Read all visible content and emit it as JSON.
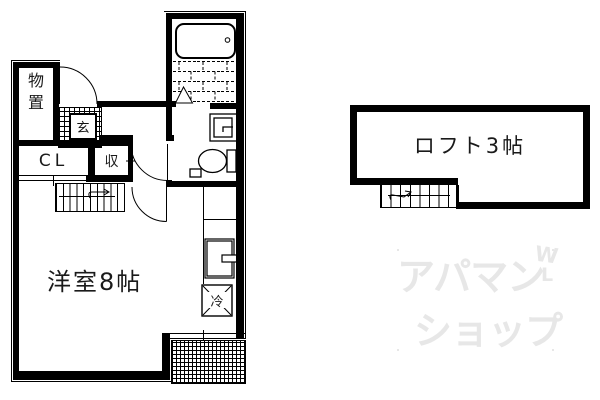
{
  "floor_plan": {
    "rooms": {
      "storage": "物置",
      "entrance": "玄",
      "closet": "CL",
      "cabinet": "収",
      "western_room": "洋室8帖",
      "refrigerator": "冷",
      "loft": "ロフト3帖"
    },
    "watermark": {
      "line1": "アパマン",
      "line2": "ショップ",
      "mark_top": "W",
      "mark_bottom": "L"
    },
    "colors": {
      "line": "#000000",
      "background": "#ffffff",
      "watermark": "#e7e7e7"
    }
  }
}
